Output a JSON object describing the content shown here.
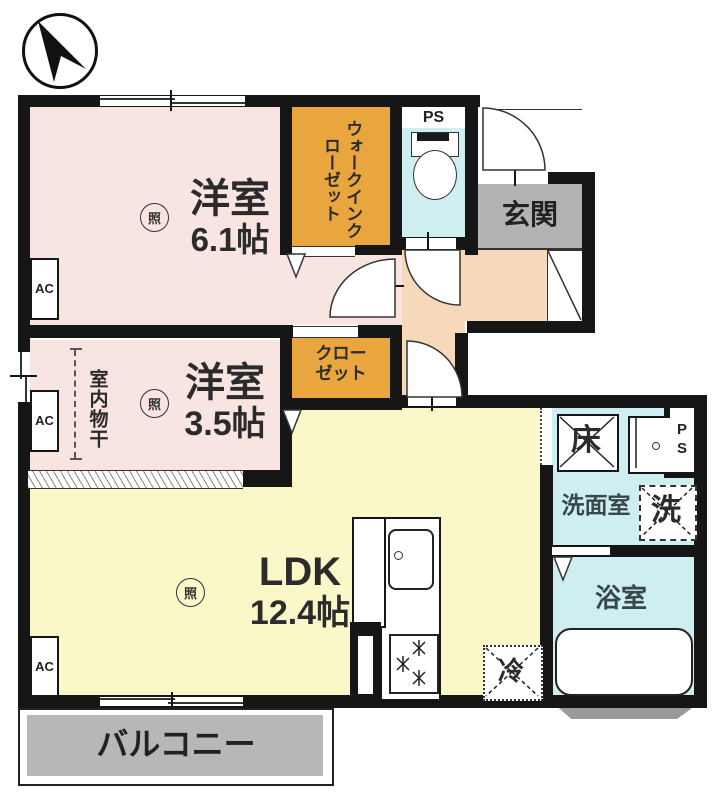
{
  "rooms": {
    "bedroom1": {
      "label": "洋室",
      "size": "6.1帖"
    },
    "bedroom2": {
      "label": "洋室",
      "size": "3.5帖"
    },
    "ldk": {
      "label": "LDK",
      "size": "12.4帖"
    },
    "wic": {
      "label": "ウォークインクローゼット"
    },
    "closet": {
      "line1": "クロー",
      "line2": "ゼット"
    },
    "genkan": {
      "label": "玄関"
    },
    "washroom": {
      "label": "洗面室"
    },
    "bathroom": {
      "label": "浴室"
    },
    "balcony": {
      "label": "バルコニー"
    }
  },
  "fixtures": {
    "ps_top": "PS",
    "ps_side": "PS",
    "floor_storage": "床",
    "washer": "洗",
    "fridge": "冷",
    "indoor_drying": "室内物干",
    "ac": "AC",
    "ceiling_light": "照"
  },
  "colors": {
    "wall": "#161616",
    "bedroom": "#f8e4e1",
    "closet": "#e9a53e",
    "ldk": "#faf7c8",
    "hall": "#f6d8ba",
    "wet_room": "#cfeef2",
    "genkan_floor": "#b3b3b3",
    "balcony_floor": "#b7b7b7"
  }
}
